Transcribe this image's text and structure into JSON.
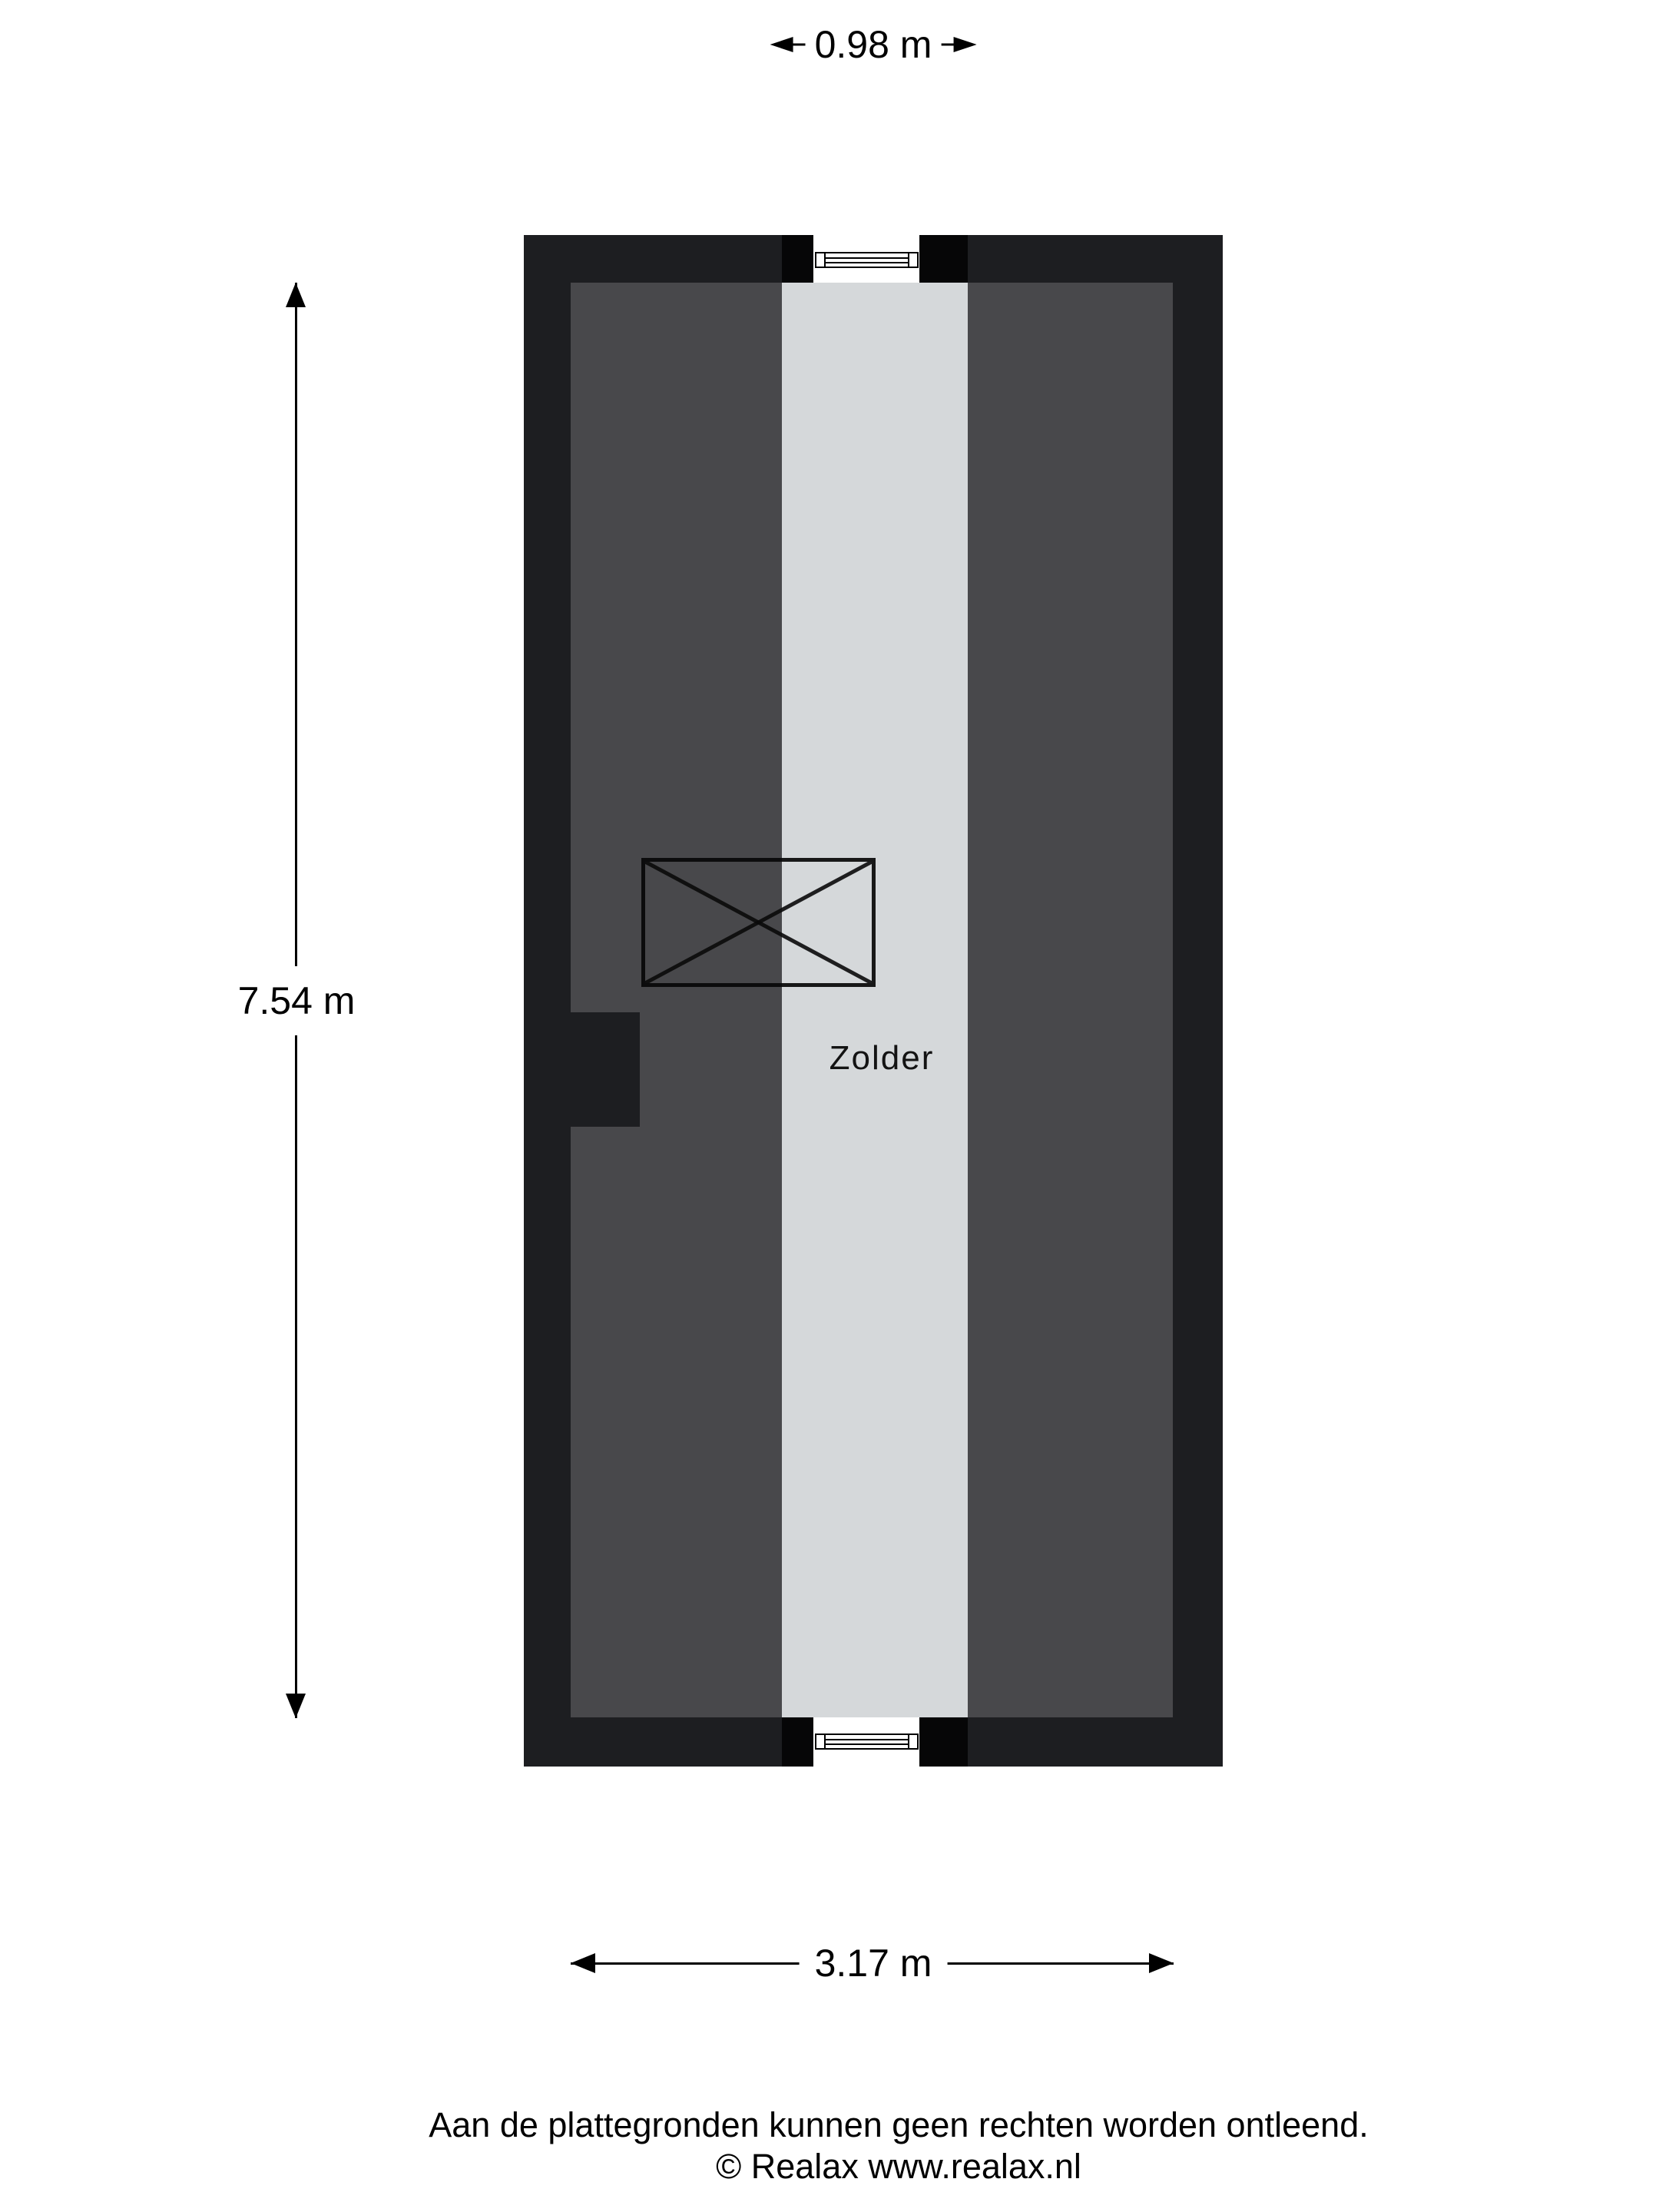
{
  "room": {
    "label": "Zolder"
  },
  "dimensions": {
    "strip_width": {
      "label": "0.98 m"
    },
    "height": {
      "label": "7.54 m"
    },
    "width": {
      "label": "3.17 m"
    }
  },
  "footer": {
    "line1": "Aan de plattegronden kunnen geen rechten worden ontleend.",
    "line2": "© Realax www.realax.nl"
  },
  "icons": {
    "window": "window-symbol",
    "stairs": "crossed-box-stairs-symbol",
    "arrows": "dimension-arrows"
  },
  "colors": {
    "wall": "#1d1e21",
    "slope": "#48484b",
    "floor": "#d5d8da",
    "block": "#060607"
  }
}
